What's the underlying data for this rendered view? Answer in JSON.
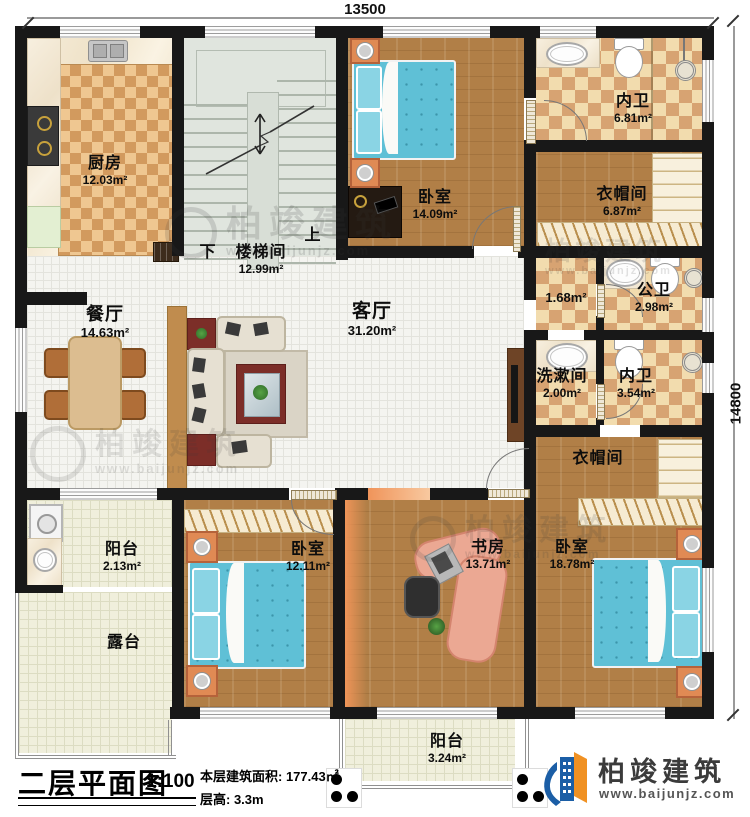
{
  "dimensions": {
    "top": "13500",
    "right": "14800"
  },
  "stair": {
    "down": "下",
    "up": "上"
  },
  "rooms": {
    "kitchen": {
      "name": "厨房",
      "area": "12.03m²"
    },
    "stairwell": {
      "name": "楼梯间",
      "area": "12.99m²"
    },
    "bedroom_top": {
      "name": "卧室",
      "area": "14.09m²"
    },
    "bath_top": {
      "name": "内卫",
      "area": "6.81m²"
    },
    "cloak_top": {
      "name": "衣帽间",
      "area": "6.87m²"
    },
    "hallway": {
      "area": "1.68m²"
    },
    "public_bath": {
      "name": "公卫",
      "area": "2.98m²"
    },
    "washroom": {
      "name": "洗漱间",
      "area": "2.00m²"
    },
    "bath_mid": {
      "name": "内卫",
      "area": "3.54m²"
    },
    "cloak_bottom": {
      "name": "衣帽间"
    },
    "dining": {
      "name": "餐厅",
      "area": "14.63m²"
    },
    "living": {
      "name": "客厅",
      "area": "31.20m²"
    },
    "balcony_left": {
      "name": "阳台",
      "area": "2.13m²"
    },
    "terrace": {
      "name": "露台"
    },
    "bedroom_left": {
      "name": "卧室",
      "area": "12.11m²"
    },
    "study": {
      "name": "书房",
      "area": "13.71m²"
    },
    "bedroom_right": {
      "name": "卧室",
      "area": "18.78m²"
    },
    "balcony_bottom": {
      "name": "阳台",
      "area": "3.24m²"
    }
  },
  "title_block": {
    "title": "二层平面图",
    "scale": "1:100",
    "floor_area": "本层建筑面积: 177.43㎡",
    "floor_height": "层高: 3.3m"
  },
  "branding": {
    "name": "柏竣建筑",
    "url": "www.baijunjz.com"
  },
  "watermark": {
    "name": "柏竣建筑",
    "url": "www.baijunjz.com"
  },
  "colors": {
    "wall": "#181818",
    "wood": "#b17f47",
    "checker": "#d7a372",
    "bed_blue": "#5fc0d6",
    "accent_orange": "#ef9458",
    "logo_blue": "#1b5ea6",
    "logo_orange": "#f09123"
  }
}
